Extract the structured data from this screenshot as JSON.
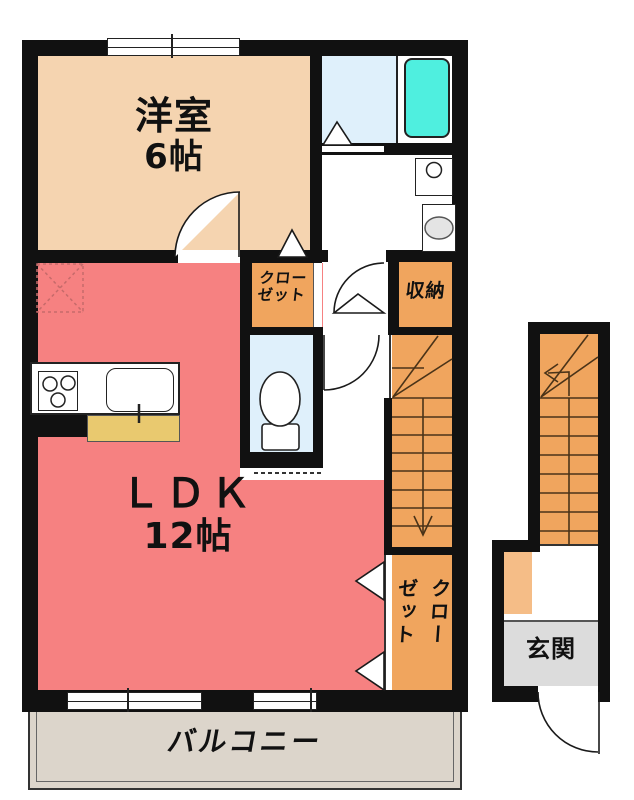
{
  "floorplan": {
    "title": "2F apartment floor plan",
    "rooms": {
      "western_room": {
        "name": "洋室",
        "size": "6帖"
      },
      "ldk": {
        "name": "ＬＤＫ",
        "size": "12帖"
      },
      "closet_upper": {
        "label": "クローゼット",
        "line1": "クロー",
        "line2": "ゼット"
      },
      "storage": {
        "label": "収納"
      },
      "closet_lower": {
        "label": "クローゼット",
        "col_right": "クロー",
        "col_left": "ゼット"
      },
      "entrance": {
        "label": "玄関"
      },
      "balcony": {
        "label": "バルコニー"
      }
    },
    "fixtures": [
      "bathtub",
      "toilet",
      "washbasin",
      "washing-machine",
      "gas-stove",
      "kitchen-sink",
      "kitchen-counter",
      "refrigerator-space",
      "staircase-down",
      "staircase-up"
    ],
    "colors": {
      "wall": "#111111",
      "western_room": "#f5d4b0",
      "ldk": "#f68181",
      "closet": "#f0a55e",
      "stairs": "#f0a55e",
      "entrance_step": "#f5bd87",
      "bathroom_floor": "#dff0fb",
      "bathtub": "#4fefdf",
      "entrance_floor": "#dcdcdc",
      "balcony_floor": "#dcd5cb",
      "kitchen_counter": "#e9c96f",
      "stair_line": "#4a3318",
      "dashed_marker": "#c66a6a"
    }
  }
}
